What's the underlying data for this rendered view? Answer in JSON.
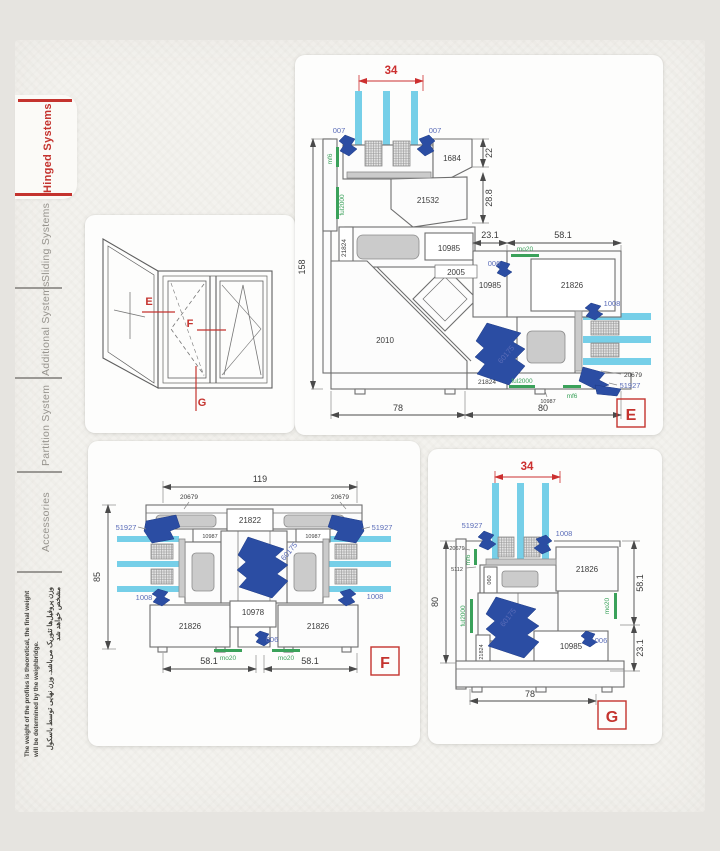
{
  "colors": {
    "accent_red": "#c4332e",
    "dim_red": "#cc2f2f",
    "label_blue": "#5a6cb8",
    "hardware_blue": "#2b4da3",
    "gasket_green": "#3aa15a",
    "glass_cyan": "#76cfe8",
    "profile_gray": "#6e6e6e",
    "tab_gray": "#97948e"
  },
  "sidebar": {
    "tabs": [
      {
        "label": "Hinged Systems",
        "active": true
      },
      {
        "label": "Sliding Systems",
        "active": false
      },
      {
        "label": "Additional Systems",
        "active": false
      },
      {
        "label": "Partition System",
        "active": false
      },
      {
        "label": "Accessories",
        "active": false
      }
    ],
    "note_fa": "وزن پروفیل‌ها تئوریک می‌باشد. وزن نهایی توسط باسکول مشخص خواهد شد",
    "note_en": "The weight of the profiles is theoretical, the final weight will be determined by the weighbridge."
  },
  "elevation": {
    "marker_e": "E",
    "marker_f": "F",
    "marker_g": "G"
  },
  "sec_e": {
    "tag": "E",
    "dim_glass": "34",
    "dim_height": "158",
    "dim_22": "22",
    "dim_288": "28.8",
    "dim_231": "23.1",
    "dim_581": "58.1",
    "dim_78": "78",
    "dim_80": "80",
    "lbl_007_l": "007",
    "lbl_007_r": "007",
    "lbl_006": "006",
    "p_1684": "1684",
    "p_21532": "21532",
    "p_10985_a": "10985",
    "p_10985_b": "10985",
    "p_2005": "2005",
    "p_2010": "2010",
    "p_21824_l": "21824",
    "p_21824_b": "21824",
    "p_21826": "21826",
    "p_10987": "10987",
    "p_20679": "20679",
    "p_51927": "51927",
    "p_1008": "1008",
    "p_60175": "60175",
    "g_mf6_top": "mf6",
    "g_ful2000_l": "ful2000",
    "g_mo20": "mo20",
    "g_ful2000_b": "ful2000",
    "g_mf6_b": "mf6"
  },
  "sec_f": {
    "tag": "F",
    "dim_119": "119",
    "dim_85": "85",
    "dim_581_l": "58.1",
    "dim_581_r": "58.1",
    "p_20679_l": "20679",
    "p_20679_r": "20679",
    "p_51927_l": "51927",
    "p_51927_r": "51927",
    "p_21822": "21822",
    "p_10987_l": "10987",
    "p_10987_r": "10987",
    "p_60175": "60175",
    "p_1008_l": "1008",
    "p_1008_r": "1008",
    "p_21826_l": "21826",
    "p_21826_r": "21826",
    "p_10978": "10978",
    "lbl_006": "006",
    "g_mo20_l": "mo20",
    "g_mo20_r": "mo20"
  },
  "sec_g": {
    "tag": "G",
    "dim_glass": "34",
    "dim_80": "80",
    "dim_78": "78",
    "dim_581": "58.1",
    "dim_231": "23.1",
    "p_51927": "51927",
    "p_1008": "1008",
    "p_20679": "20679",
    "p_5112": "5112",
    "p_060": "060",
    "p_21826": "21826",
    "p_10985": "10985",
    "p_21824": "21824",
    "p_60175": "60175",
    "lbl_006": "006",
    "g_mf6": "mf6",
    "g_ful2000": "ful2000",
    "g_mo20": "mo20"
  }
}
